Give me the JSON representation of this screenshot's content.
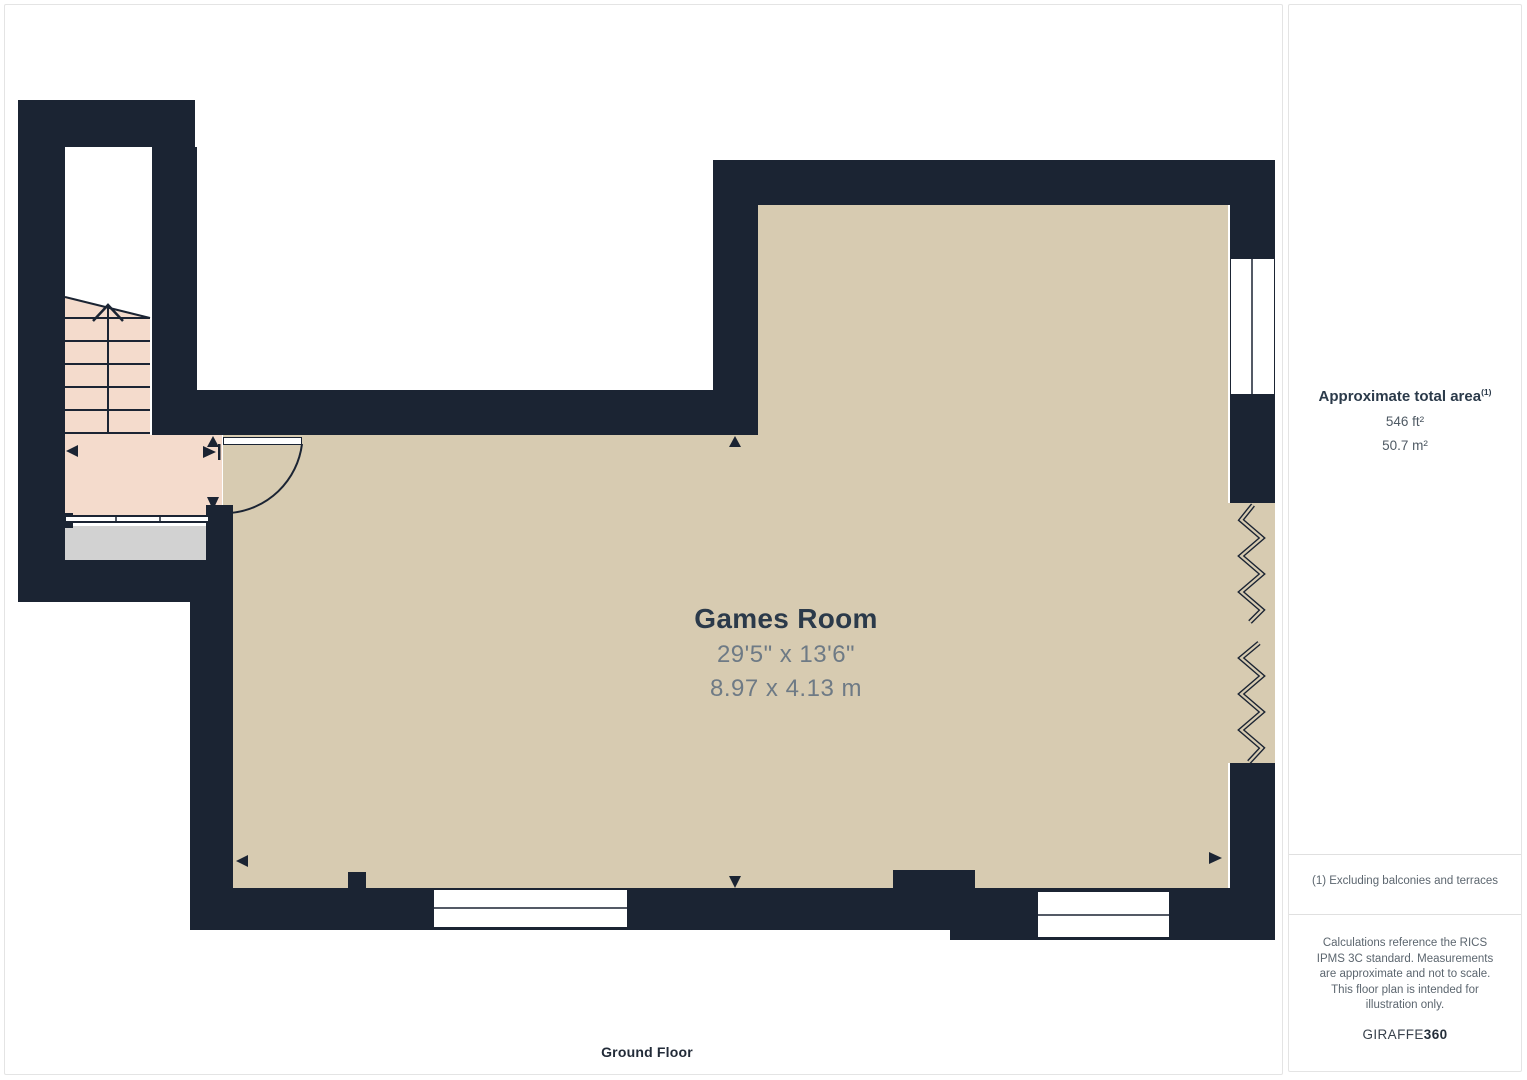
{
  "plan": {
    "room": {
      "name": "Games Room",
      "dim_imperial": "29'5\" x 13'6\"",
      "dim_metric": "8.97 x 4.13 m"
    },
    "floor_label": "Ground Floor"
  },
  "sidebar": {
    "area_title": "Approximate total area",
    "area_superscript": "(1)",
    "area_ft": "546 ft²",
    "area_m": "50.7 m²",
    "footnote": "(1) Excluding balconies and terraces",
    "disclaimer": "Calculations reference the RICS IPMS 3C standard. Measurements are approximate and not to scale. This floor plan is intended for illustration only.",
    "brand_name": "GIRAFFE",
    "brand_suffix": "360"
  },
  "colors": {
    "wall": "#1b2433",
    "room_fill": "#d7cbb1",
    "stairs_fill": "#f4dbcc",
    "landing_gray": "#d2d2d2",
    "text_dark": "#2b3a4a",
    "text_gray": "#6e7a85",
    "divider": "#e0e0e0"
  }
}
